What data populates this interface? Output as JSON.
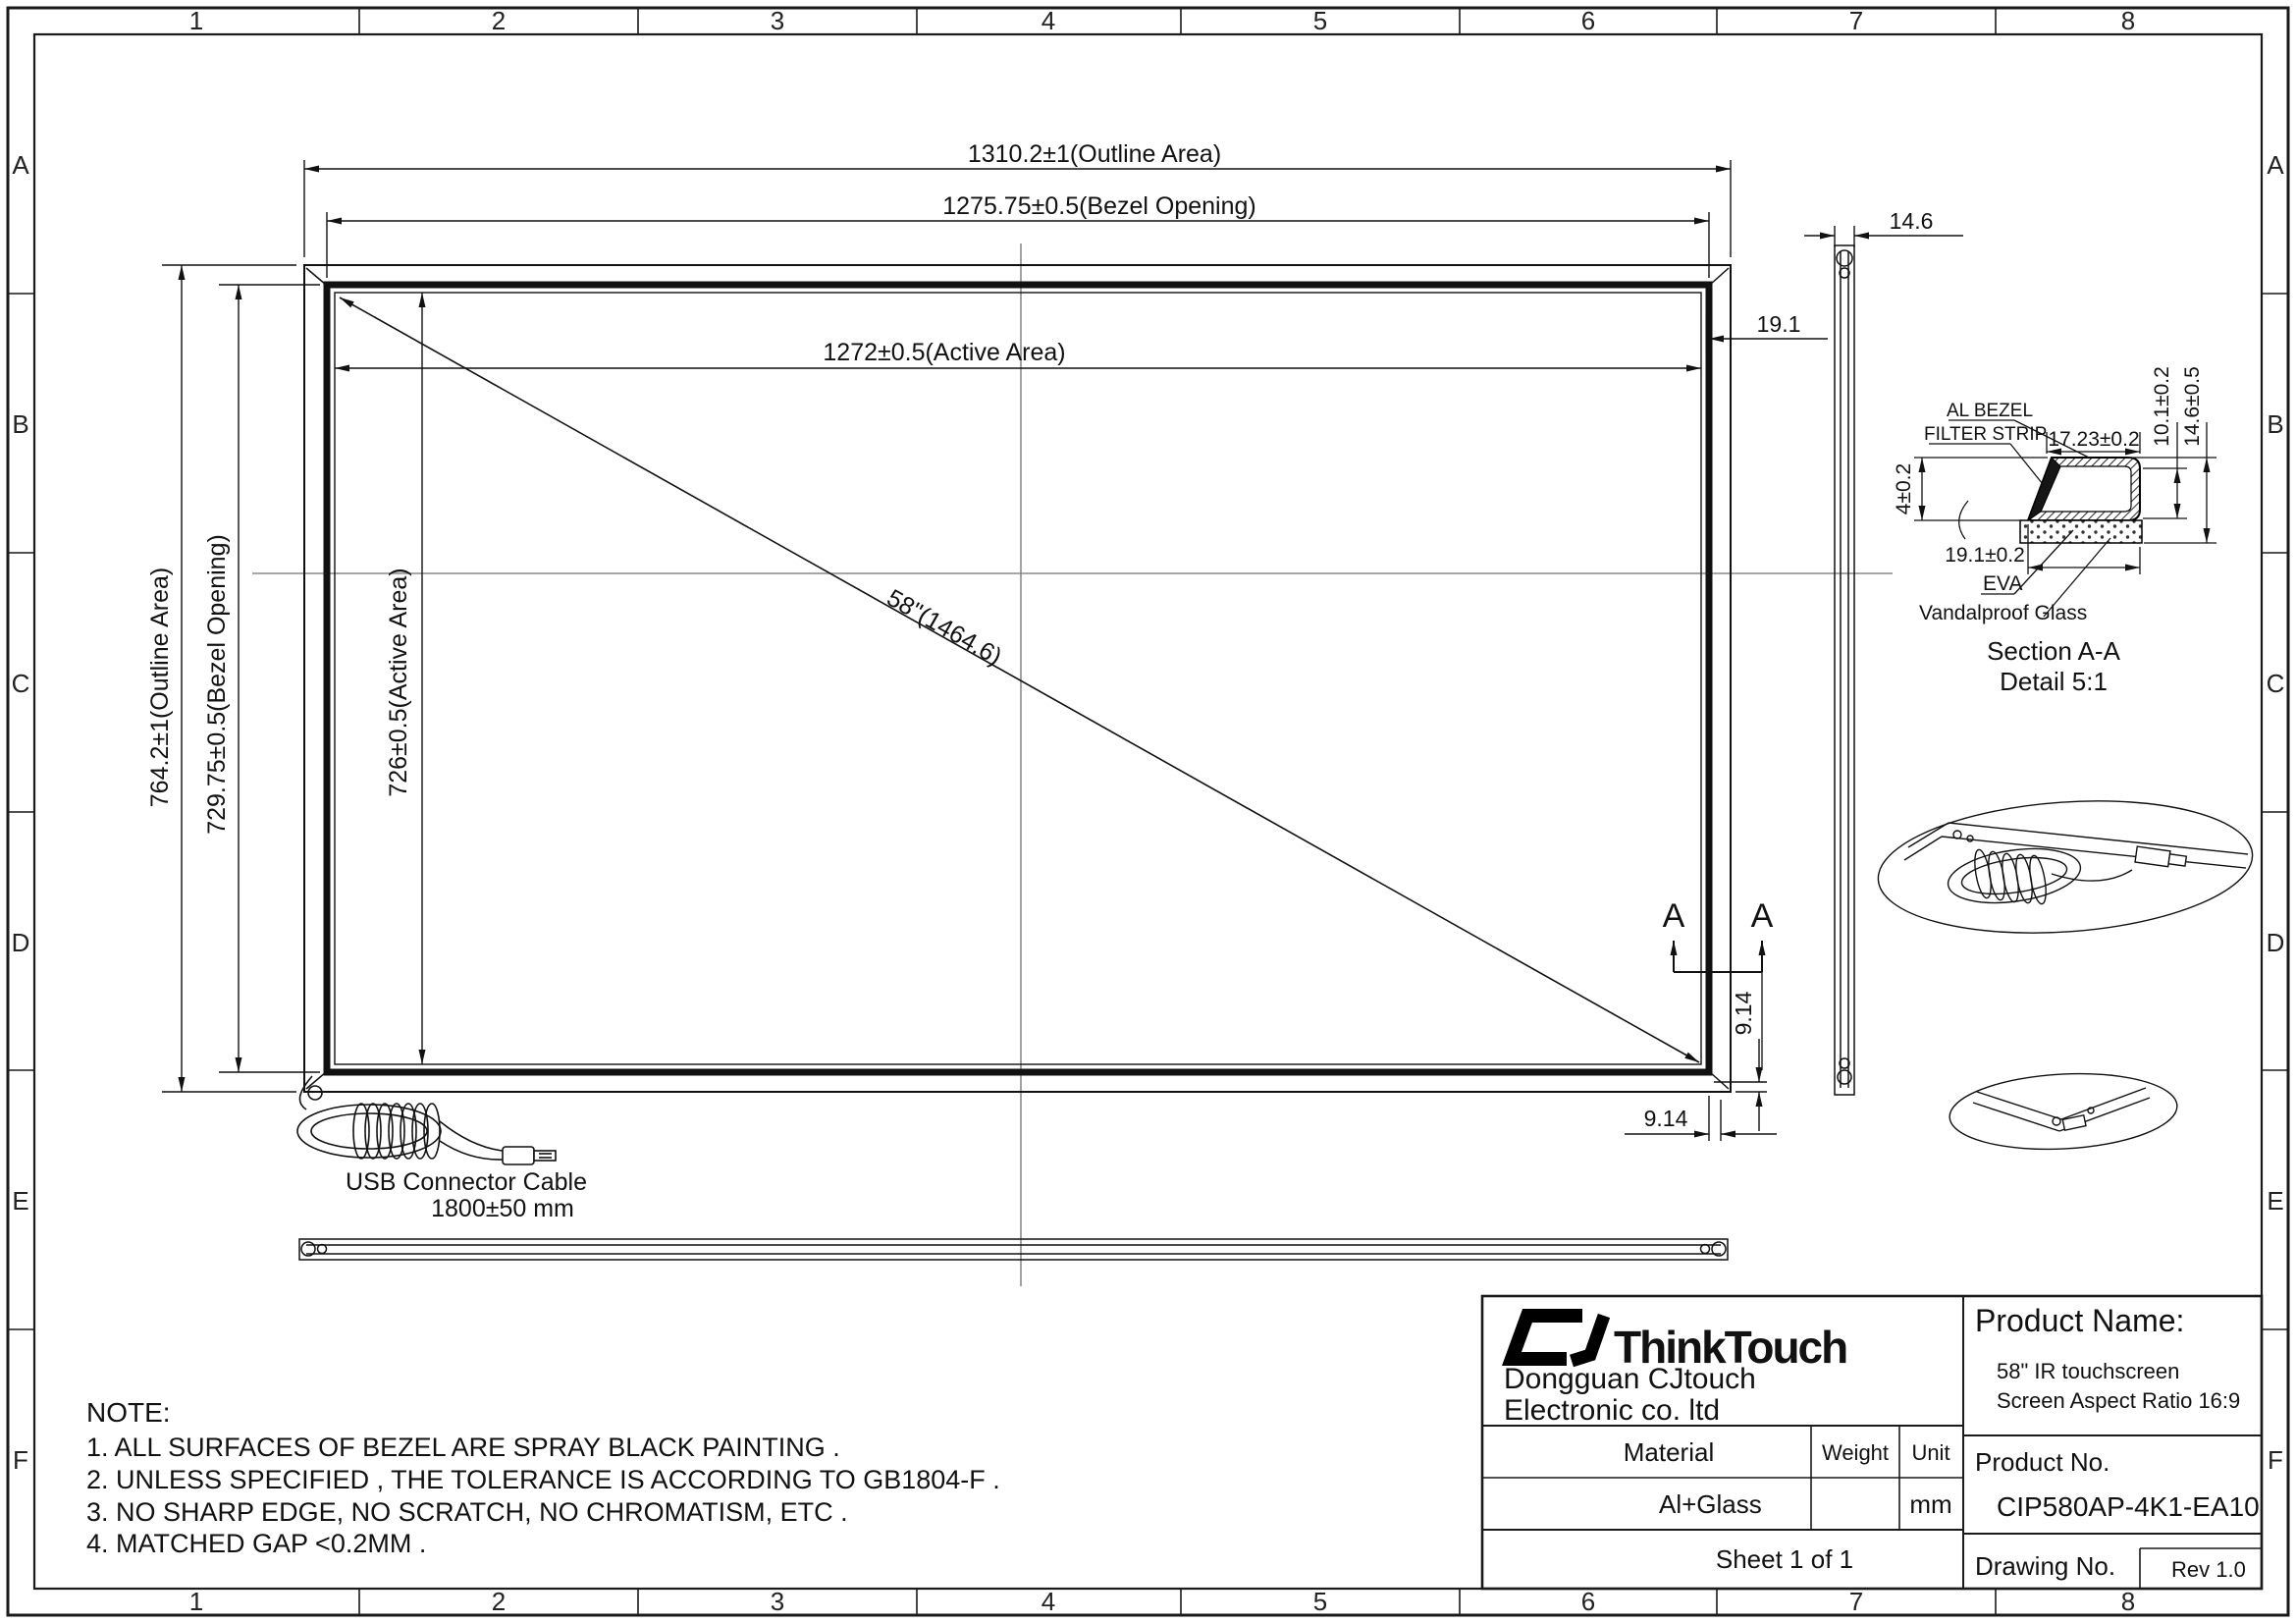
{
  "sheet": {
    "columns": [
      "1",
      "2",
      "3",
      "4",
      "5",
      "6",
      "7",
      "8"
    ],
    "rows": [
      "A",
      "B",
      "C",
      "D",
      "E",
      "F"
    ]
  },
  "front_view": {
    "dim_outline_width": "1310.2±1(Outline Area)",
    "dim_bezel_opening_width": "1275.75±0.5(Bezel Opening)",
    "dim_active_width": "1272±0.5(Active Area)",
    "dim_outline_height": "764.2±1(Outline Area)",
    "dim_bezel_opening_height": "729.75±0.5(Bezel Opening)",
    "dim_active_height": "726±0.5(Active Area)",
    "dim_diagonal": "58\"(1464.6)",
    "dim_bezel_width_right": "19.1",
    "dim_thickness": "14.6",
    "dim_corner_vertical": "9.14",
    "dim_corner_horizontal": "9.14",
    "section_marker_left": "A",
    "section_marker_right": "A",
    "usb_cable_label": "USB Connector Cable",
    "usb_cable_length": "1800±50 mm"
  },
  "section_detail": {
    "label_al_bezel": "AL BEZEL",
    "label_filter_strip": "FILTER STRIP",
    "dim_top_width": "17.23±0.2",
    "dim_left_height": "4±0.2",
    "dim_right_inner": "10.1±0.2",
    "dim_right_outer": "14.6±0.5",
    "dim_bottom_width": "19.1±0.2",
    "label_eva": "EVA",
    "label_glass": "Vandalproof Glass",
    "title": "Section A-A",
    "subtitle": "Detail 5:1"
  },
  "notes": {
    "title": "NOTE:",
    "items": [
      "1. ALL SURFACES OF BEZEL ARE SPRAY BLACK PAINTING .",
      "2. UNLESS SPECIFIED , THE TOLERANCE IS ACCORDING TO GB1804-F .",
      "3. NO SHARP EDGE, NO SCRATCH, NO CHROMATISM, ETC .",
      "4. MATCHED GAP <0.2MM ."
    ]
  },
  "title_block": {
    "brand": "ThinkTouch",
    "company_line1": "Dongguan CJtouch",
    "company_line2": "Electronic co. ltd",
    "product_name_label": "Product Name:",
    "product_name_line1": "58\" IR touchscreen",
    "product_name_line2": "Screen Aspect Ratio 16:9",
    "material_label": "Material",
    "weight_label": "Weight",
    "unit_label": "Unit",
    "material_value": "Al+Glass",
    "unit_value": "mm",
    "product_no_label": "Product No.",
    "product_no_value": "CIP580AP-4K1-EA10",
    "drawing_no_label": "Drawing No.",
    "sheet_label": "Sheet 1 of 1",
    "rev_label": "Rev 1.0"
  }
}
